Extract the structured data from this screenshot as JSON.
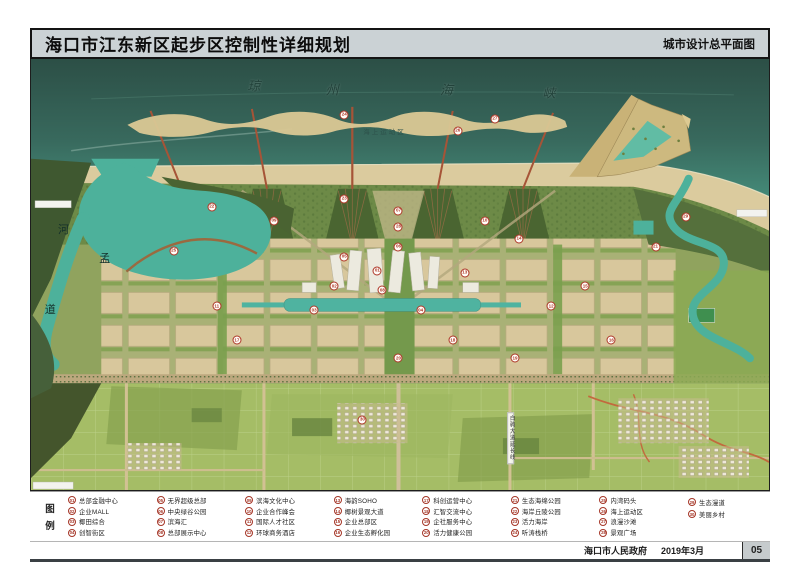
{
  "header": {
    "title": "海口市江东新区起步区控制性详细规划",
    "subtitle": "城市设计总平面图"
  },
  "map": {
    "sea_name_chars": [
      "琼",
      "州",
      "海",
      "峡"
    ],
    "sea_area_label": "海上运动区",
    "river_name_chars": [
      "河",
      "孟",
      "道"
    ],
    "road_label_vertical": "白驹大道延长线",
    "markers": [
      {
        "n": "01",
        "x": 345,
        "y": 212
      },
      {
        "n": "02",
        "x": 302,
        "y": 228
      },
      {
        "n": "03",
        "x": 282,
        "y": 252
      },
      {
        "n": "04",
        "x": 388,
        "y": 252
      },
      {
        "n": "05",
        "x": 312,
        "y": 198
      },
      {
        "n": "06",
        "x": 366,
        "y": 188
      },
      {
        "n": "07",
        "x": 366,
        "y": 152
      },
      {
        "n": "08",
        "x": 350,
        "y": 232
      },
      {
        "n": "09",
        "x": 242,
        "y": 162
      },
      {
        "n": "10",
        "x": 452,
        "y": 162
      },
      {
        "n": "11",
        "x": 185,
        "y": 248
      },
      {
        "n": "12",
        "x": 518,
        "y": 248
      },
      {
        "n": "13",
        "x": 432,
        "y": 214
      },
      {
        "n": "14",
        "x": 486,
        "y": 180
      },
      {
        "n": "15",
        "x": 552,
        "y": 228
      },
      {
        "n": "16",
        "x": 578,
        "y": 282
      },
      {
        "n": "17",
        "x": 205,
        "y": 282
      },
      {
        "n": "18",
        "x": 420,
        "y": 282
      },
      {
        "n": "19",
        "x": 482,
        "y": 300
      },
      {
        "n": "20",
        "x": 366,
        "y": 300
      },
      {
        "n": "21",
        "x": 622,
        "y": 188
      },
      {
        "n": "22",
        "x": 180,
        "y": 148
      },
      {
        "n": "23",
        "x": 312,
        "y": 140
      },
      {
        "n": "24",
        "x": 312,
        "y": 56
      },
      {
        "n": "25",
        "x": 142,
        "y": 192
      },
      {
        "n": "26",
        "x": 425,
        "y": 72
      },
      {
        "n": "27",
        "x": 462,
        "y": 60
      },
      {
        "n": "28",
        "x": 366,
        "y": 168
      },
      {
        "n": "29",
        "x": 652,
        "y": 158
      },
      {
        "n": "30",
        "x": 330,
        "y": 362
      }
    ]
  },
  "legend": {
    "title_chars": [
      "图",
      "例"
    ],
    "columns": [
      [
        {
          "n": "01",
          "label": "总部金融中心"
        },
        {
          "n": "02",
          "label": "企业MALL"
        },
        {
          "n": "03",
          "label": "椰田综合"
        },
        {
          "n": "04",
          "label": "创智街区"
        }
      ],
      [
        {
          "n": "05",
          "label": "无界超级总部"
        },
        {
          "n": "06",
          "label": "中央绿谷公园"
        },
        {
          "n": "07",
          "label": "滨海汇"
        },
        {
          "n": "08",
          "label": "总部展示中心"
        }
      ],
      [
        {
          "n": "09",
          "label": "滨海文化中心"
        },
        {
          "n": "10",
          "label": "企业合作峰会"
        },
        {
          "n": "11",
          "label": "国际人才社区"
        },
        {
          "n": "12",
          "label": "环球商务酒店"
        }
      ],
      [
        {
          "n": "13",
          "label": "海韵SOHO"
        },
        {
          "n": "14",
          "label": "椰树景观大道"
        },
        {
          "n": "15",
          "label": "企业总部区"
        },
        {
          "n": "16",
          "label": "企业生态孵化园"
        }
      ],
      [
        {
          "n": "17",
          "label": "科创运营中心"
        },
        {
          "n": "18",
          "label": "汇智交流中心"
        },
        {
          "n": "19",
          "label": "企社服务中心"
        },
        {
          "n": "20",
          "label": "活力健康公园"
        }
      ],
      [
        {
          "n": "21",
          "label": "生态海绵公园"
        },
        {
          "n": "22",
          "label": "海岸丘陵公园"
        },
        {
          "n": "23",
          "label": "活力海岸"
        },
        {
          "n": "24",
          "label": "听涛栈桥"
        }
      ],
      [
        {
          "n": "25",
          "label": "内湾码头"
        },
        {
          "n": "26",
          "label": "海上运动区"
        },
        {
          "n": "27",
          "label": "浪漫沙滩"
        },
        {
          "n": "28",
          "label": "景观广场"
        }
      ],
      [
        {
          "n": "29",
          "label": "生态漫道"
        },
        {
          "n": "30",
          "label": "美丽乡村"
        }
      ]
    ]
  },
  "footer": {
    "publisher": "海口市人民政府",
    "date": "2019年3月",
    "page": "05"
  },
  "colors": {
    "sea_deep": "#2c4f46",
    "sea_shallow": "#52ab94",
    "beach": "#dbcb9e",
    "urban_block": "#d8c79c",
    "marker_red": "#ad3526",
    "header_bg": "#cbd2d5"
  }
}
